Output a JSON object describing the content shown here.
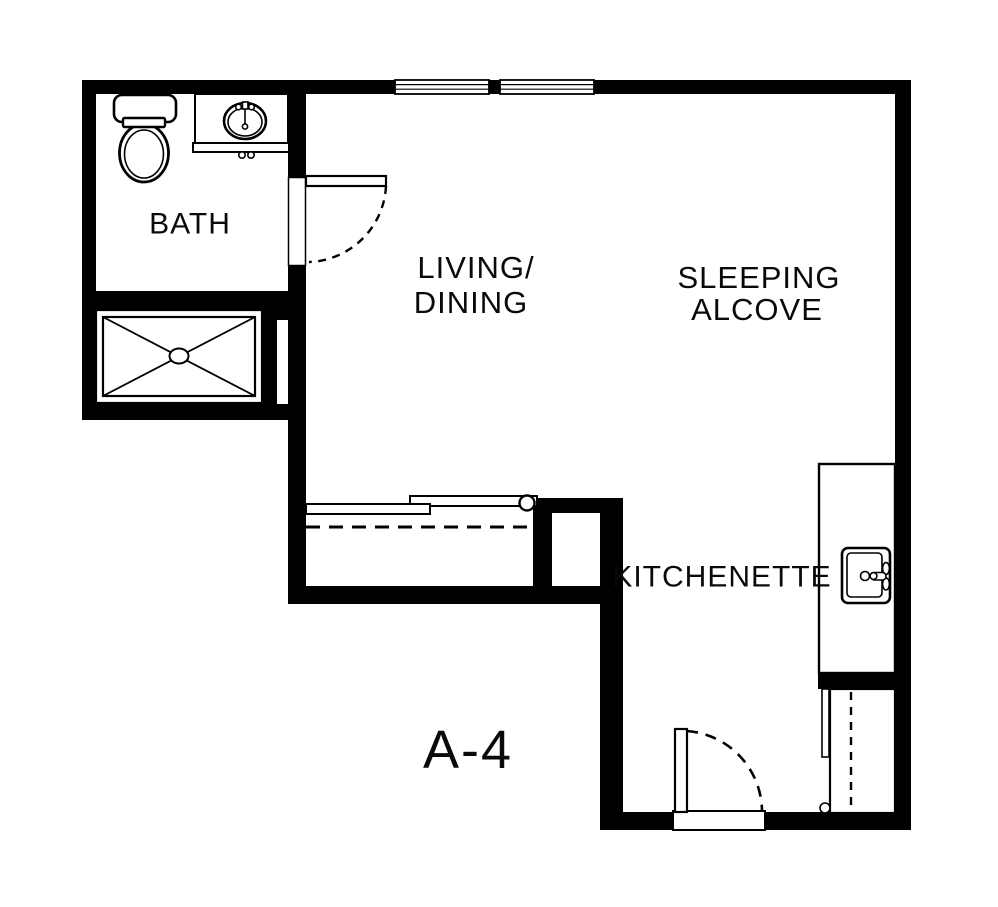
{
  "plan": {
    "title": "A-4",
    "background_color": "#ffffff",
    "line_color": "#000000",
    "rooms": {
      "bath": {
        "label": "BATH"
      },
      "living_dining": {
        "label_line1": "LIVING/",
        "label_line2": "DINING"
      },
      "sleeping_alcove": {
        "label_line1": "SLEEPING",
        "label_line2": "ALCOVE"
      },
      "kitchenette": {
        "label": "KITCHENETTE"
      }
    },
    "fixtures": {
      "bath": [
        "toilet",
        "vanity-sink",
        "shower"
      ],
      "kitchenette": [
        "counter",
        "kitchen-sink",
        "refrigerator"
      ],
      "closet": [
        "sliding-bypass-doors",
        "closet-rod"
      ],
      "doors": [
        "bath-door",
        "entry-door"
      ],
      "window_count": 2
    }
  }
}
